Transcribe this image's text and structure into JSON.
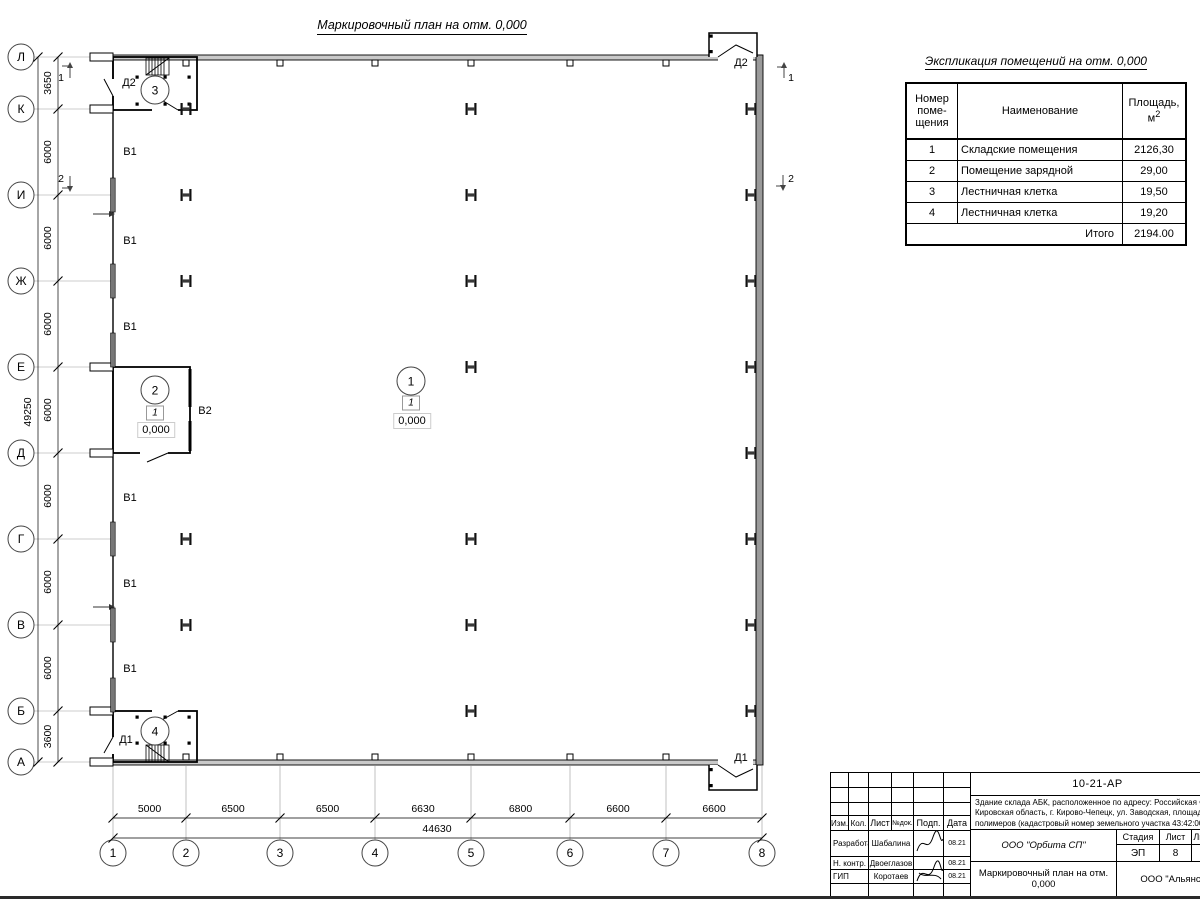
{
  "sheet": {
    "title": "Маркировочный план на отм. 0,000"
  },
  "axes": {
    "left": [
      "Л",
      "К",
      "И",
      "Ж",
      "Е",
      "Д",
      "Г",
      "В",
      "Б",
      "А"
    ],
    "bottom": [
      "1",
      "2",
      "3",
      "4",
      "5",
      "6",
      "7",
      "8"
    ]
  },
  "dimensions": {
    "left_segments": [
      "3650",
      "6000",
      "6000",
      "6000",
      "6000",
      "6000",
      "6000",
      "6000",
      "3600"
    ],
    "left_total": "49250",
    "bottom_segments": [
      "5000",
      "6500",
      "6500",
      "6630",
      "6800",
      "6600",
      "6600"
    ],
    "bottom_total": "44630"
  },
  "plan_annotations": [
    {
      "text": "Д2",
      "x": 129,
      "y": 83
    },
    {
      "text": "Д2",
      "x": 741,
      "y": 63
    },
    {
      "text": "Д1",
      "x": 126,
      "y": 740
    },
    {
      "text": "Д1",
      "x": 741,
      "y": 758
    },
    {
      "text": "В1",
      "x": 130,
      "y": 152
    },
    {
      "text": "В1",
      "x": 130,
      "y": 241
    },
    {
      "text": "В1",
      "x": 130,
      "y": 327
    },
    {
      "text": "В1",
      "x": 130,
      "y": 498
    },
    {
      "text": "В1",
      "x": 130,
      "y": 584
    },
    {
      "text": "В1",
      "x": 130,
      "y": 669
    },
    {
      "text": "В2",
      "x": 205,
      "y": 411
    },
    {
      "text": "1",
      "x": 61,
      "y": 78
    },
    {
      "text": "2",
      "x": 61,
      "y": 179
    },
    {
      "text": "1",
      "x": 791,
      "y": 78
    },
    {
      "text": "2",
      "x": 791,
      "y": 179
    }
  ],
  "room_markers": [
    {
      "number": "3",
      "x": 155,
      "y": 90
    },
    {
      "number": "2",
      "x": 155,
      "y": 390
    },
    {
      "number": "1",
      "x": 411,
      "y": 381
    },
    {
      "number": "4",
      "x": 155,
      "y": 731
    }
  ],
  "floor_flags": [
    {
      "text": "1",
      "x": 155,
      "y": 413
    },
    {
      "text": "1",
      "x": 411,
      "y": 403
    }
  ],
  "levels": [
    {
      "text": "0,000",
      "x": 156,
      "y": 430
    },
    {
      "text": "0,000",
      "x": 412,
      "y": 421
    }
  ],
  "exp_table": {
    "title": "Экспликация помещений на отм. 0,000",
    "col1_lines": [
      "Номер",
      "поме-",
      "щения"
    ],
    "col2": "Наименование",
    "col3_line1": "Площадь,",
    "col3_unit": "м",
    "col3_sup": "2",
    "rows": [
      {
        "num": "1",
        "name": "Складские помещения",
        "area": "2126,30"
      },
      {
        "num": "2",
        "name": "Помещение зарядной",
        "area": "29,00"
      },
      {
        "num": "3",
        "name": "Лестничная клетка",
        "area": "19,50"
      },
      {
        "num": "4",
        "name": "Лестничная клетка",
        "area": "19,20"
      }
    ],
    "total_label": "Итого",
    "total_value": "2194.00"
  },
  "title_block": {
    "doc_number": "10-21-АР",
    "object_lines": [
      "Здание склада АБК, расположенное по адресу: Российская Феде",
      "Кировская область, г. Кирово-Чепецк, ул. Заводская, площадка з",
      "полимеров (кадастровый номер земельного участка 43:42:00000"
    ],
    "columns": [
      "Изм.",
      "Кол.",
      "Лист",
      "№док.",
      "Подп.",
      "Дата"
    ],
    "roles": [
      {
        "role": "Разработал",
        "name": "Шабалина",
        "date": "08.21"
      },
      {
        "role": "Н. контр.",
        "name": "Двоеглазов",
        "date": "08.21"
      },
      {
        "role": "ГИП",
        "name": "Коротаев",
        "date": "08.21"
      }
    ],
    "org": "ООО \"Орбита СП\"",
    "stage_label": "Стадия",
    "sheet_label": "Лист",
    "sheets_label": "Листов",
    "stage": "ЭП",
    "sheet_num": "8",
    "sheets_num": "17",
    "plan_name_lines": [
      "Маркировочный план на отм.",
      "0,000"
    ],
    "contractor": "ООО \"Альянс"
  }
}
